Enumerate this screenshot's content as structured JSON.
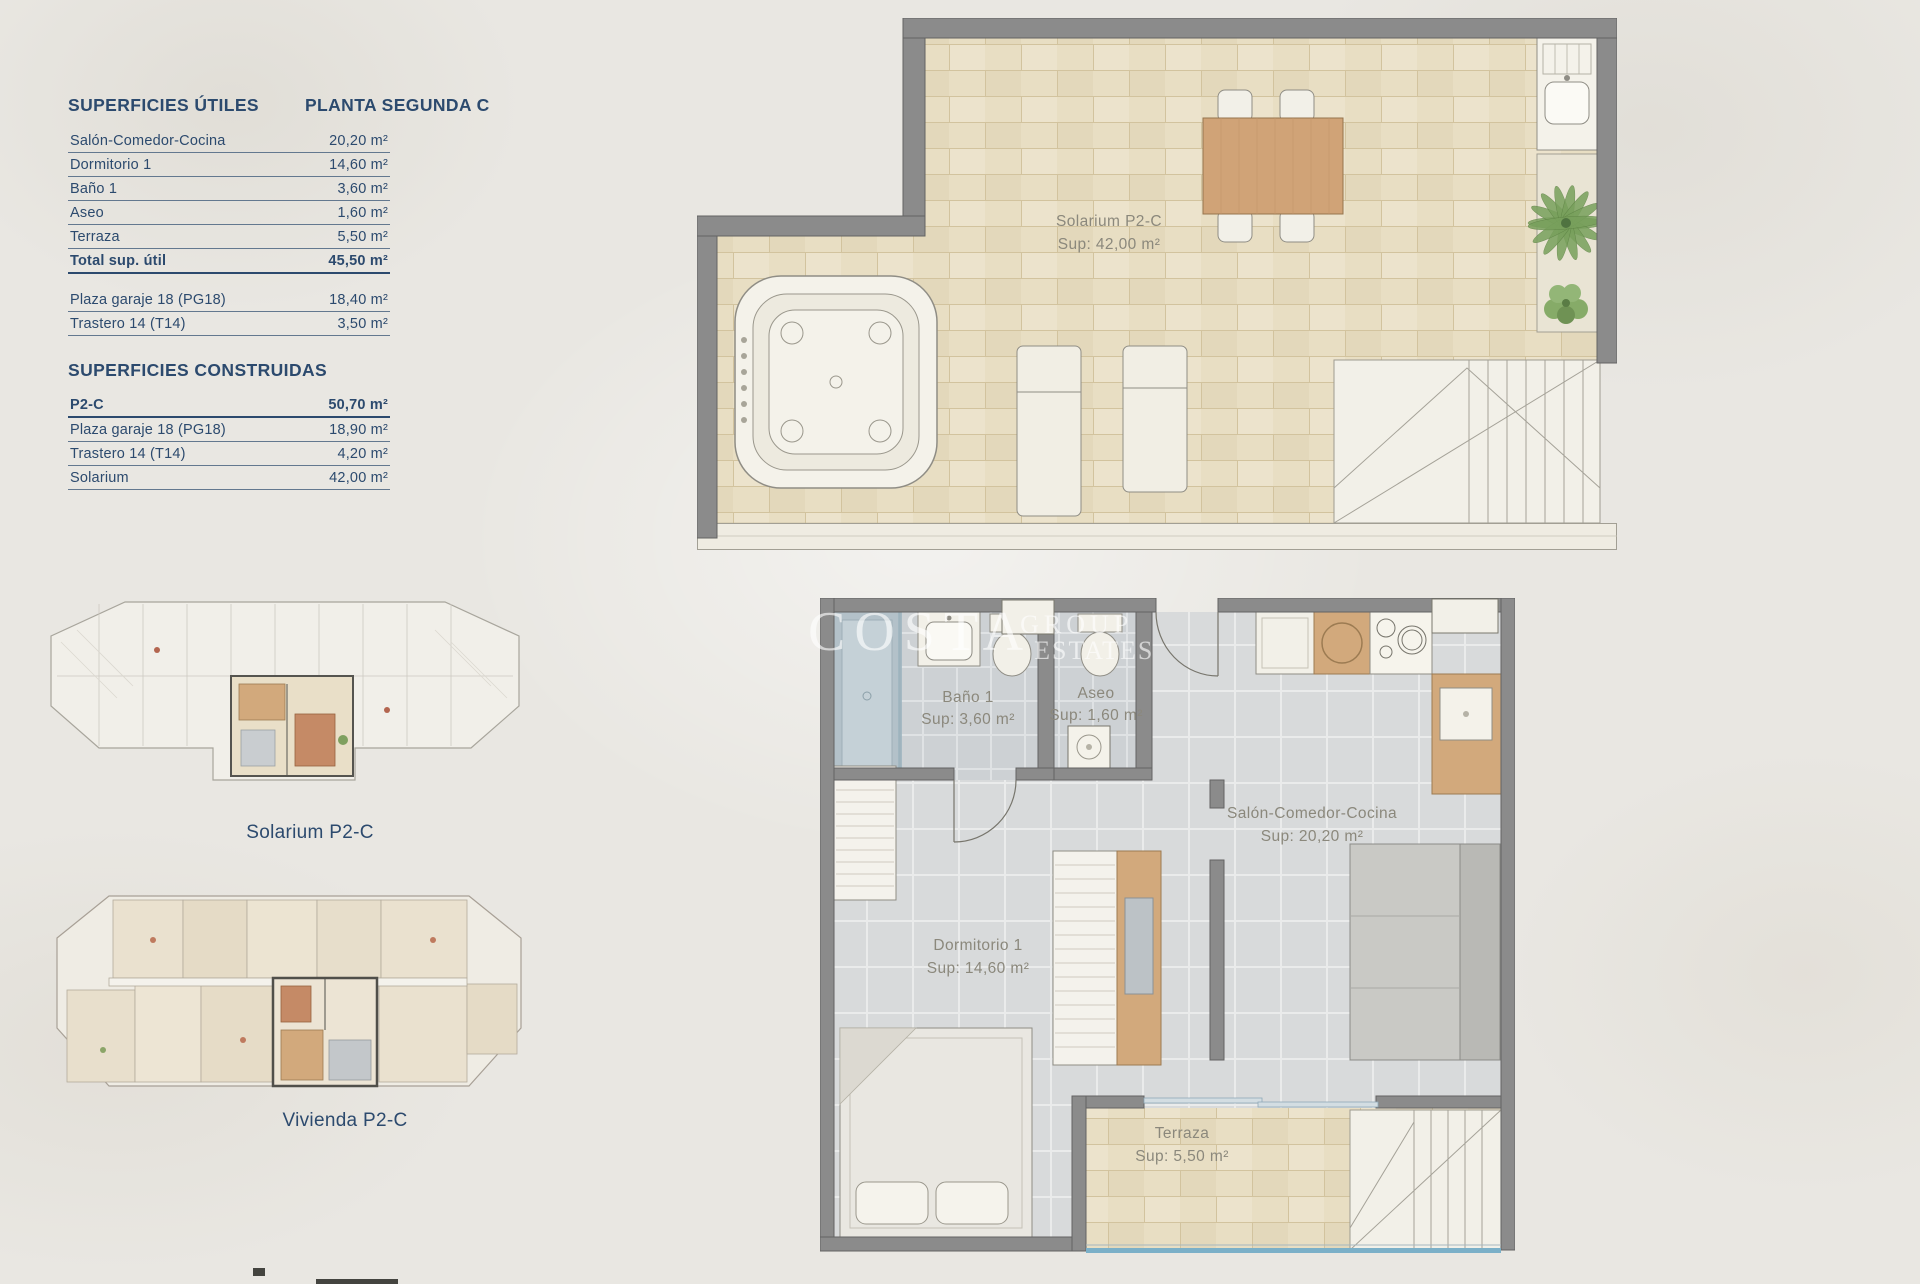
{
  "tables": {
    "utiles": {
      "title": "SUPERFICIES ÚTILES",
      "subtitle": "PLANTA SEGUNDA C",
      "rows": [
        {
          "label": "Salón-Comedor-Cocina",
          "value": "20,20 m²"
        },
        {
          "label": "Dormitorio 1",
          "value": "14,60 m²"
        },
        {
          "label": "Baño 1",
          "value": "3,60 m²"
        },
        {
          "label": "Aseo",
          "value": "1,60 m²"
        },
        {
          "label": "Terraza",
          "value": "5,50 m²"
        }
      ],
      "total": {
        "label": "Total sup. útil",
        "value": "45,50 m²"
      },
      "extras": [
        {
          "label": "Plaza garaje 18 (PG18)",
          "value": "18,40 m²"
        },
        {
          "label": "Trastero 14 (T14)",
          "value": "3,50 m²"
        }
      ]
    },
    "construidas": {
      "title": "SUPERFICIES CONSTRUIDAS",
      "rows": [
        {
          "label": "P2-C",
          "value": "50,70 m²"
        },
        {
          "label": "Plaza garaje 18 (PG18)",
          "value": "18,90 m²"
        },
        {
          "label": "Trastero 14 (T14)",
          "value": "4,20 m²"
        },
        {
          "label": "Solarium",
          "value": "42,00 m²"
        }
      ]
    }
  },
  "plans": {
    "solarium": {
      "name": "Solarium P2-C",
      "sup": "Sup: 42,00 m²"
    },
    "vivienda": {
      "bano": {
        "name": "Baño 1",
        "sup": "Sup: 3,60 m²"
      },
      "aseo": {
        "name": "Aseo",
        "sup": "Sup: 1,60 m²"
      },
      "salon": {
        "name": "Salón-Comedor-Cocina",
        "sup": "Sup: 20,20 m²"
      },
      "dormitorio": {
        "name": "Dormitorio 1",
        "sup": "Sup: 14,60 m²"
      },
      "terraza": {
        "name": "Terraza",
        "sup": "Sup: 5,50 m²"
      }
    },
    "mini_solarium_caption": "Solarium P2-C",
    "mini_vivienda_caption": "Vivienda P2-C"
  },
  "watermark": {
    "line1": "COSTA",
    "line2": "GROUP",
    "line3": "ESTATES"
  },
  "colors": {
    "accent_navy": "#2c4a6e",
    "plan_label_gray": "#8b887c",
    "wall_gray": "#8b8b8b",
    "brick_beige": "#e8dec3",
    "tile_gray": "#d8dadb",
    "wood_tan": "#d2a97c",
    "glass_blue": "#7bb0c8",
    "plant_green": "#78a05c"
  }
}
